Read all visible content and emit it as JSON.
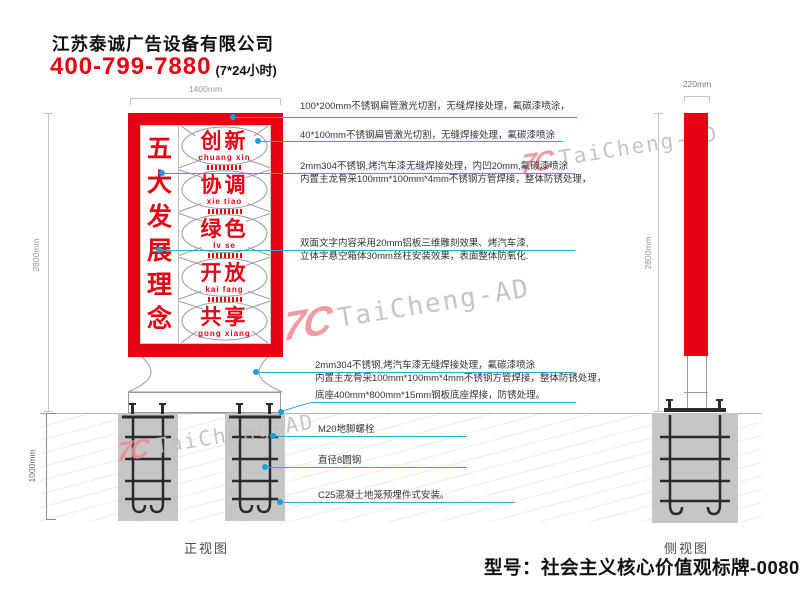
{
  "header": {
    "company": "江苏泰诚广告设备有限公司",
    "phone": "400-799-7880",
    "hours": "(7*24小时)"
  },
  "front_view": {
    "label": "正视图",
    "dim_width": "1400mm",
    "dim_height": "2800mm",
    "dim_depth": "1000mm",
    "sign": {
      "side_chars": [
        "五",
        "大",
        "发",
        "展",
        "理",
        "念"
      ],
      "words": [
        {
          "cn": "创新",
          "py": "chuang xin"
        },
        {
          "cn": "协调",
          "py": "xie tiao"
        },
        {
          "cn": "绿色",
          "py": "lv se"
        },
        {
          "cn": "开放",
          "py": "kai fang"
        },
        {
          "cn": "共享",
          "py": "gong xiang"
        }
      ]
    }
  },
  "side_view": {
    "label": "侧视图",
    "dim_width": "220mm",
    "dim_height": "2800mm"
  },
  "annotations": [
    {
      "line1": "100*200mm不锈钢扁管激光切割，无缝焊接处理，氟碳漆喷涂，",
      "line2": ""
    },
    {
      "line1": "40*100mm不锈钢扁管激光切割，无缝焊接处理，氟碳漆喷涂",
      "line2": ""
    },
    {
      "line1": "2mm304不锈钢,烤汽车漆无缝焊接处理，内凹20mm,氟碳漆喷涂",
      "line2": "内置主龙骨采100mm*100mm*4mm不锈钢方管焊接，整体防锈处理，"
    },
    {
      "line1": "双面文字内容采用20mm铝板三维雕刻效果、烤汽车漆,",
      "line2": "立体字悬空箱体30mm丝柱安装效果，表面整体防氧化."
    },
    {
      "line1": "2mm304不锈钢,烤汽车漆无缝焊接处理，氟碳漆喷涂",
      "line2": "内置主龙骨采100mm*100mm*4mm不锈钢方管焊接，整体防锈处理，"
    },
    {
      "line1": "底座400mm*800mm*15mm钢板底座焊接，防锈处理。",
      "line2": ""
    },
    {
      "line1": "M20地脚螺栓",
      "line2": ""
    },
    {
      "line1": "直径8圆钢",
      "line2": ""
    },
    {
      "line1": "C25混凝土地笼预埋件式安装。",
      "line2": ""
    }
  ],
  "watermark": {
    "logo": "7C",
    "text": "TaiCheng-AD"
  },
  "footer": {
    "model": "型号：社会主义核心价值观标牌-0080"
  },
  "colors": {
    "red": "#e60012",
    "leader_blue": "#29abe2",
    "foundation_gray": "#c6c6c6"
  }
}
